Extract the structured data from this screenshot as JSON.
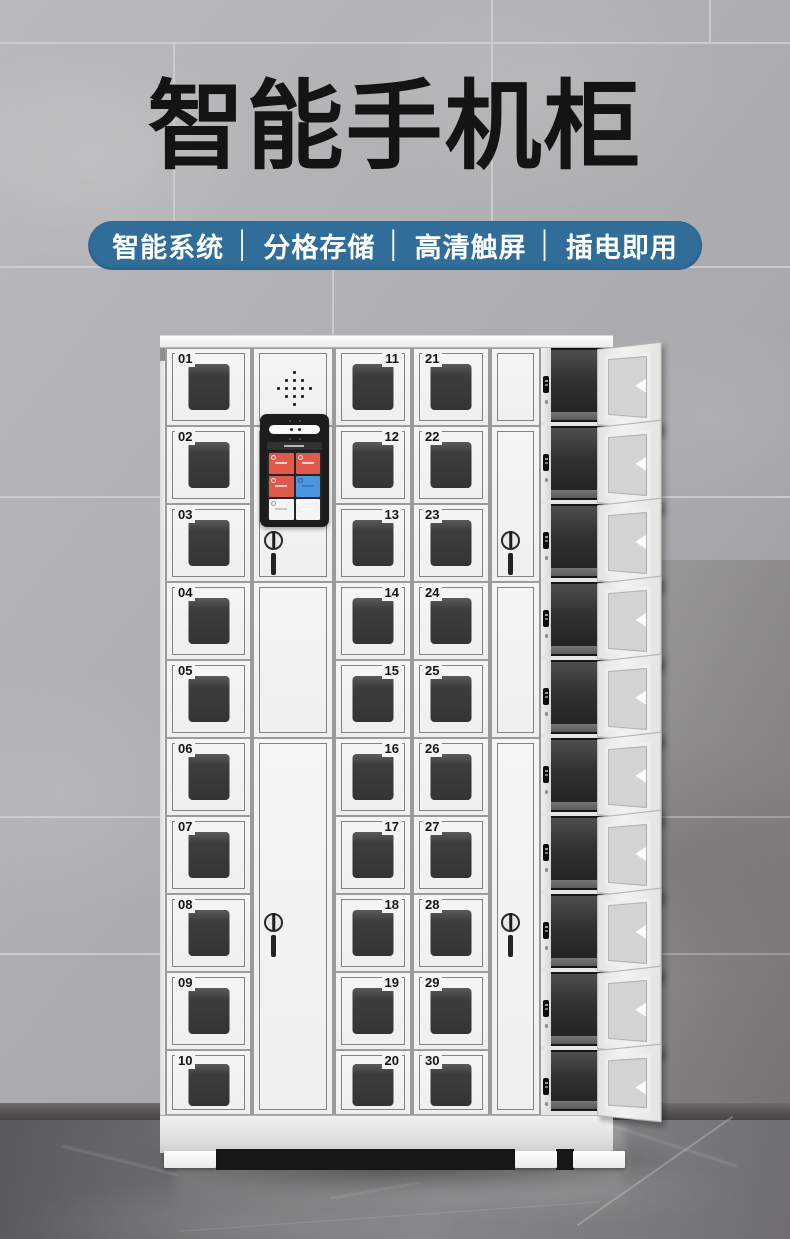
{
  "header": {
    "title": "智能手机柜",
    "features": [
      "智能系统",
      "分格存储",
      "高清触屏",
      "插电即用"
    ],
    "separator": "│"
  },
  "cabinet": {
    "left_column_numbers": [
      "01",
      "02",
      "03",
      "04",
      "05",
      "06",
      "07",
      "08",
      "09",
      "10"
    ],
    "middle_column_numbers": [
      "11",
      "12",
      "13",
      "14",
      "15",
      "16",
      "17",
      "18",
      "19",
      "20"
    ],
    "right_column_numbers": [
      "21",
      "22",
      "23",
      "24",
      "25",
      "26",
      "27",
      "28",
      "29",
      "30"
    ],
    "open_compartment_count": 10,
    "screen": {
      "tiles": [
        "#e05a4c",
        "#e05a4c",
        "#e05a4c",
        "#4a96df",
        "#f4f4f2",
        "#f4f4f2"
      ]
    }
  },
  "palette": {
    "banner_blue": "#306d99",
    "title_black": "#141414",
    "cabinet_white": "#f3f3f1",
    "screen_red": "#e05a4c",
    "screen_blue": "#4a96df",
    "wall_gray": "#b2b2b4",
    "floor_gray": "#77757a"
  }
}
